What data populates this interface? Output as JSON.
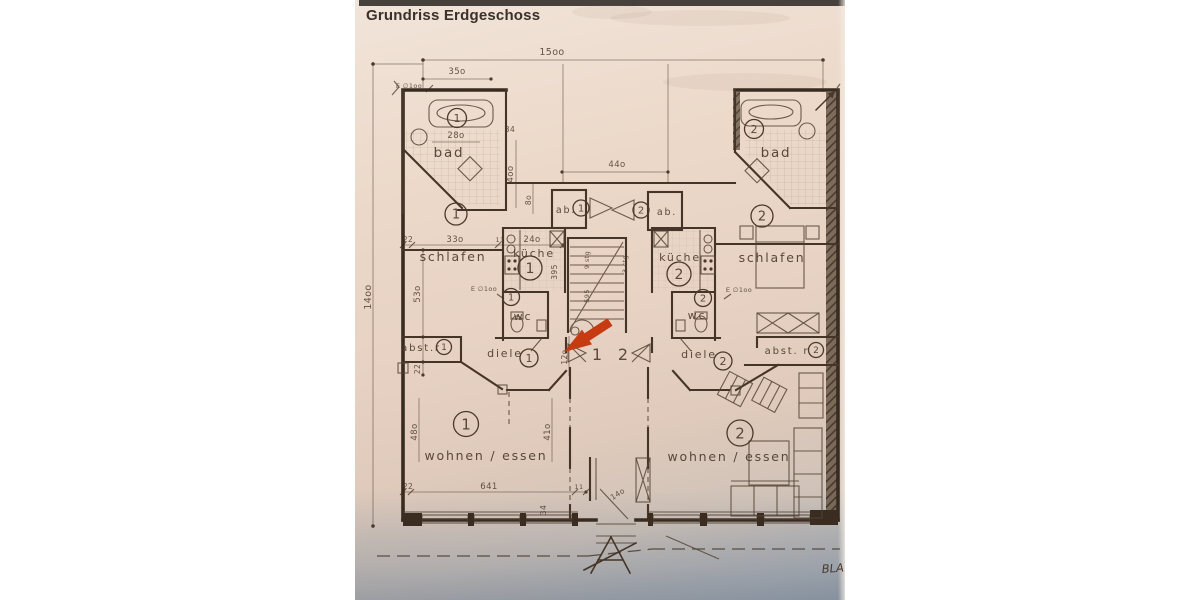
{
  "title": "Grundriss Erdgeschoss",
  "page": {
    "corner_note": "BLA"
  },
  "colors": {
    "paper": "#e8d4c6",
    "ink": "#4a392c",
    "annotation_red": "#c63b12"
  },
  "units": {
    "one": "1",
    "two": "2"
  },
  "rooms": {
    "bad": "bad",
    "schlafen": "schlafen",
    "kueche": "küche",
    "wc": "wc",
    "abst": "abst.r",
    "abst2": "abst. r",
    "diele": "diele",
    "wohnen": "wohnen / essen",
    "ab": "ab."
  },
  "dims": {
    "w_total": "15oo",
    "h_total": "14oo",
    "front": "35o",
    "center": "44o",
    "bad_w": "28o",
    "bad_s": "34",
    "bad_h": "4oo",
    "ab_h": "8o",
    "t22": "22",
    "t33o": "33o",
    "t11": "11",
    "t24o": "24o",
    "schlafen_h": "53o",
    "kueche_h": "395",
    "diele_h": "12o",
    "wohnen_h": "48o",
    "wohnen_h2": "41o",
    "wohnen_w": "641",
    "win34": "34",
    "porch": "14o",
    "vent": "E ∅1oo",
    "stair_a": "9 stg",
    "stair_b": "595",
    "stair_c": "3 stg"
  }
}
